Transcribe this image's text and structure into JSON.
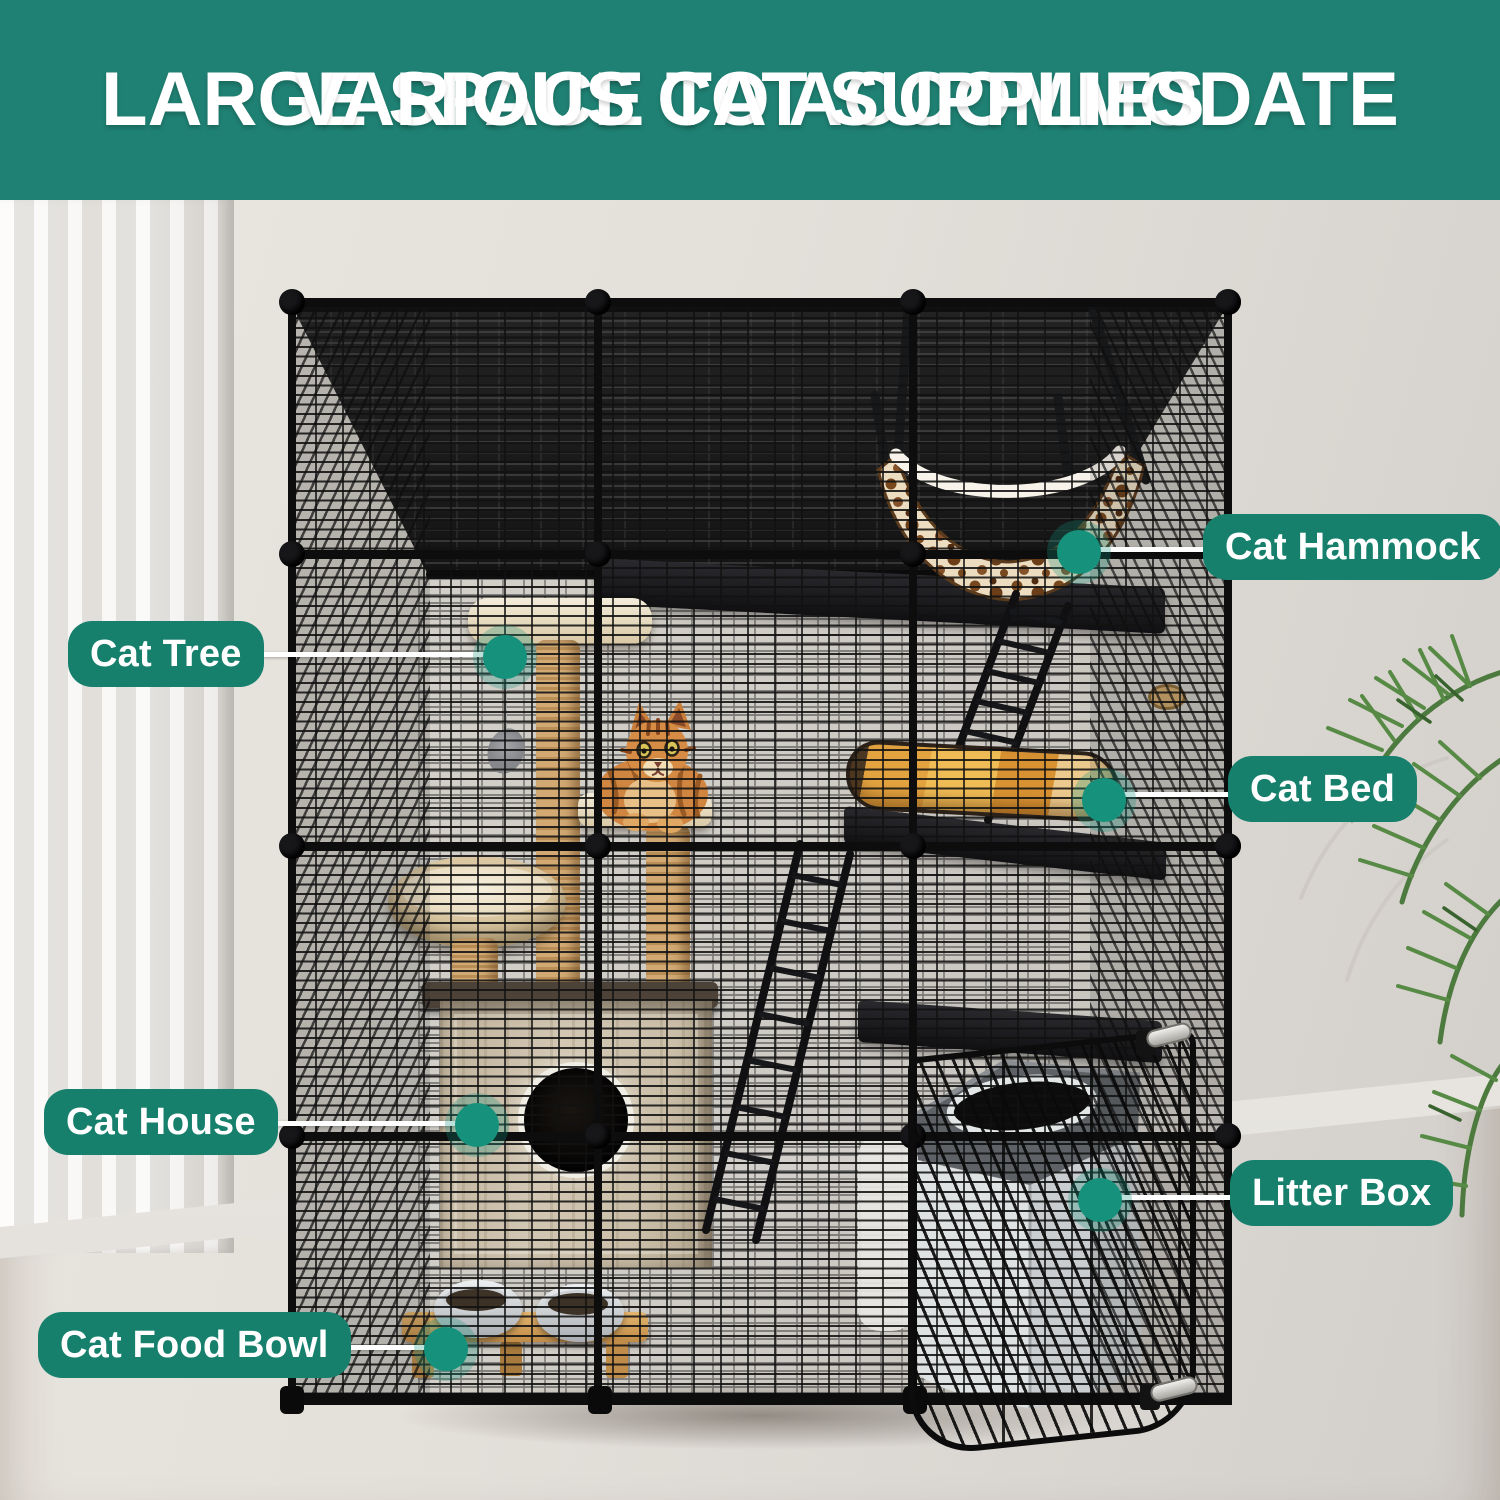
{
  "header": {
    "line1": "LARGE SPACE TO ACCOMMODATE",
    "line2": "VARIOUS CAT SUPPLIES"
  },
  "callouts": [
    {
      "id": "cat-hammock",
      "label": "Cat Hammock"
    },
    {
      "id": "cat-tree",
      "label": "Cat Tree"
    },
    {
      "id": "cat-bed",
      "label": "Cat Bed"
    },
    {
      "id": "cat-house",
      "label": "Cat House"
    },
    {
      "id": "litter-box",
      "label": "Litter Box"
    },
    {
      "id": "cat-food-bowl",
      "label": "Cat Food Bowl"
    }
  ],
  "colors": {
    "banner_teal": "#1F8173",
    "label_pill_teal": "#17806D",
    "callout_dot_teal": "#16917B",
    "callout_line": "#FFFFFF",
    "text": "#FFFFFF"
  },
  "scene": {
    "objects": [
      "black wire cat cage",
      "cat hammock",
      "cat tree",
      "orange tabby cat",
      "cat bed",
      "cat house",
      "litter box",
      "cat food bowls",
      "white curtain",
      "green plant",
      "wood floor"
    ]
  }
}
